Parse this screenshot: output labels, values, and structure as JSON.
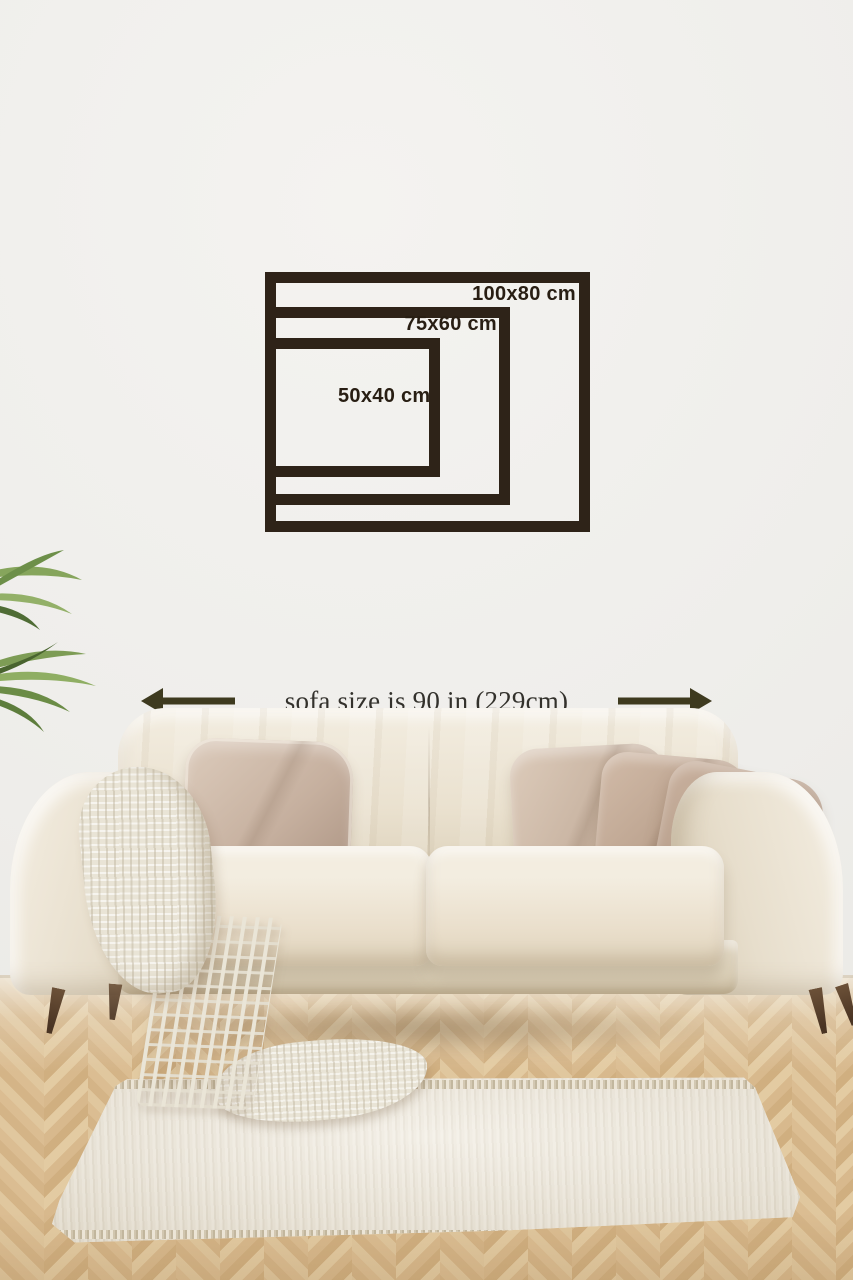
{
  "size_guide": {
    "description_icon": "nested-frames-diagram",
    "frames": [
      {
        "label": "100x80 cm",
        "width_cm": 100,
        "height_cm": 80
      },
      {
        "label": "75x60 cm",
        "width_cm": 75,
        "height_cm": 60
      },
      {
        "label": "50x40 cm",
        "width_cm": 50,
        "height_cm": 40
      }
    ]
  },
  "sofa_note": {
    "text": "sofa size is 90 in (229cm)",
    "left_icon": "arrow-left-icon",
    "right_icon": "arrow-right-icon"
  },
  "scene_objects": [
    "frame-size-diagram",
    "sofa",
    "throw-pillows",
    "knit-throw-blanket",
    "area-rug",
    "potted-plant-leaves",
    "herringbone-wood-floor"
  ],
  "colors": {
    "frame": "#2e2318",
    "frameLabel": "#281e13",
    "olive": "#3e3a1f",
    "noteText": "#33312c",
    "wall": "#f0efec",
    "floorBase": "#d5b689",
    "sofa": "#ebe3d3",
    "rug": "#e8e1d2",
    "leg": "#5a4330",
    "plant": "#7d9c55"
  }
}
